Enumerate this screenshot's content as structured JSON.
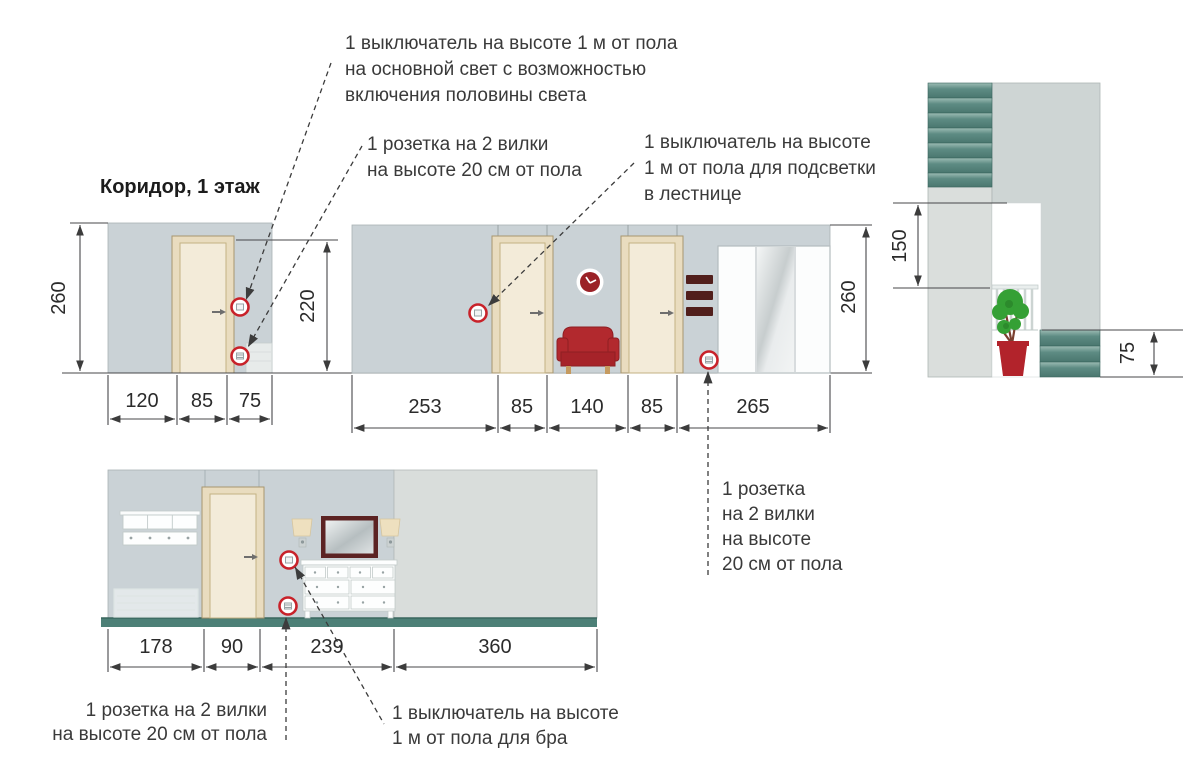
{
  "title": "Коридор, 1 этаж",
  "notes": {
    "main_switch": "1 выключатель на высоте 1 м от пола\nна основной свет  с возможностью\nвключения половины света",
    "socket_hall": "1 розетка на 2 вилки\nна высоте 20 см от пола",
    "stair_switch": "1 выключатель на высоте\n1 м от пола для подсветки\nв лестнице",
    "socket_wardrobe": "1 розетка\nна 2 вилки\nна высоте\n20 см от пола",
    "socket_bottom": "1 розетка на 2 вилки\nна высоте 20 см от пола",
    "bra_switch": "1 выключатель на высоте\n1 м от пола для бра"
  },
  "dimensions": {
    "left": {
      "height": "260",
      "door_zone_height": "220",
      "widths": [
        "120",
        "85",
        "75"
      ]
    },
    "middle": {
      "height": "260",
      "widths": [
        "253",
        "85",
        "140",
        "85",
        "265"
      ]
    },
    "stairs": {
      "opening_height": "150",
      "step_height": "75"
    },
    "bottom": {
      "widths": [
        "178",
        "90",
        "239",
        "360"
      ]
    }
  },
  "colors": {
    "wall": "#cad2d6",
    "wall_light": "#d9dddb",
    "accent_red": "#b6262c",
    "circle_ring_red": "#c8222a",
    "teal": "#4d8077",
    "door_fill": "#f3ebd9",
    "mirror_frame": "#5c2323",
    "line": "#3c3c3c"
  }
}
